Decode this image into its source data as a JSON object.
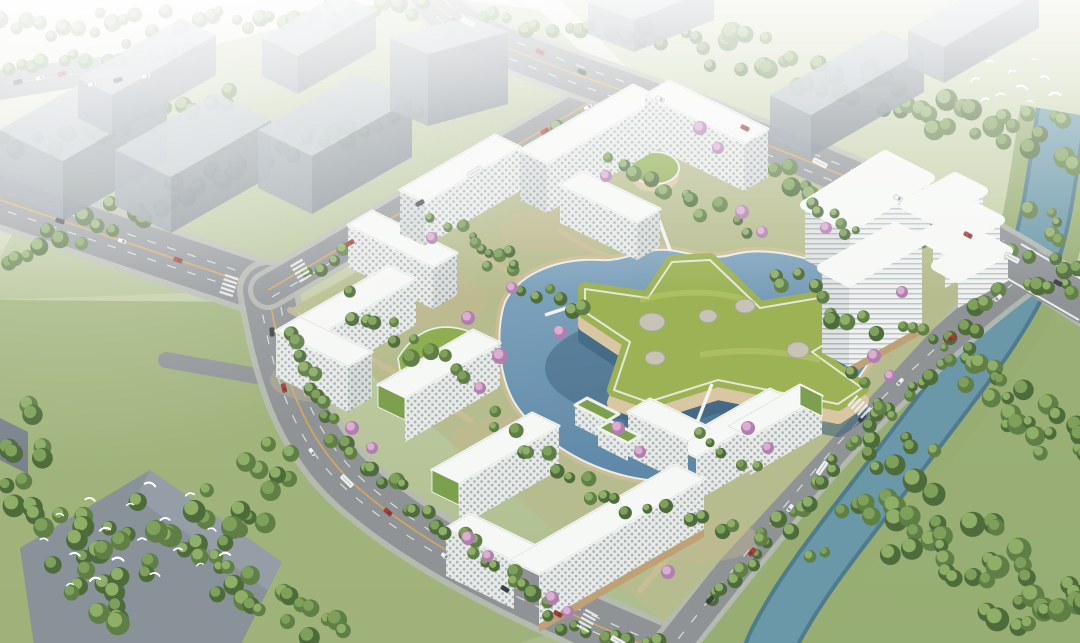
{
  "meta": {
    "image_kind": "architectural aerial rendering",
    "subject": "terraced residential campus masterplan with star-shaped green-roof pavilion",
    "atmosphere": "hazy daylight, bird's-eye perspective"
  },
  "palette": {
    "sky_top": "#e9ede5",
    "ground": "#aabc8c",
    "grass_nw": "#aebe8e",
    "grass_ne": "#bcc99a",
    "grass_se": "#93aa6e",
    "grass_sw": "#9cb077",
    "site_ground": "#b6bc8d",
    "forest_dark": "#4e6b3c",
    "forest_mid": "#5f7f46",
    "tree_light": "#7fa05a",
    "tree_pale": "#8fae68",
    "road": "#8f9396",
    "sidewalk": "#b6bab2",
    "lane_yellow": "#d8a85c",
    "lane_white": "#f3f4f2",
    "massing_top": "#b3bcc4",
    "massing_front": "#8d97a1",
    "massing_side": "#79828c",
    "massing_roof_big": "#87909a",
    "river": "#6b98a8",
    "river_edge": "#4f7b8d",
    "river_bank": "#97ad72",
    "water_light": "#83a7c0",
    "water_deep": "#5e88a6",
    "water_shadow": "#3a5e79",
    "star_roof": "#9cb254",
    "star_light": "#b9cb70",
    "roof_white": "#f6f8f5",
    "roof_edge": "#d9ded9",
    "facade_base": "#e7eae6",
    "facade_shade": "#d7dcd9",
    "window": "#a9b2b6",
    "stripe": "#bcc4c8",
    "stripe_dark": "#adb5ba",
    "terrace_green": "#7da04f",
    "podium_cream": "#d8c7a2",
    "base_wood": "#c0a176",
    "path_tan": "#cdbd97",
    "sand": "#c8b995",
    "blossom": "#b07fae",
    "blossom_light": "#d9aed1",
    "skylight": "#c7c3b6",
    "skylight_rim": "#a8a69a",
    "car_red": "#b23834",
    "car_dark": "#3b4046",
    "car_white": "#edefed",
    "bird_white": "#ffffff",
    "haze": "#ffffff"
  },
  "scene": {
    "development": {
      "residential_buildings": 16,
      "office_buildings": 5,
      "central_pavilion": "star-shaped green roof over water",
      "roof_skylights": 5,
      "round_green_podiums": 2,
      "footbridges": 3,
      "landscape_features": [
        "central lake",
        "canals",
        "lawns",
        "cherry blossom trees",
        "stepped green terraces"
      ]
    },
    "context": {
      "gray_massing_blocks": 10,
      "bird_flocks": 2,
      "river": "tree-lined channel along the southeast",
      "parking_rows": "upper-left corner"
    },
    "roads": [
      "west avenue",
      "northwest boundary road",
      "northeast highway with river bridge",
      "riverside road",
      "west feeder lane"
    ],
    "vehicles": {
      "cars": 31,
      "buses_trucks": 8,
      "colors": [
        "red",
        "white",
        "dark gray"
      ]
    }
  }
}
